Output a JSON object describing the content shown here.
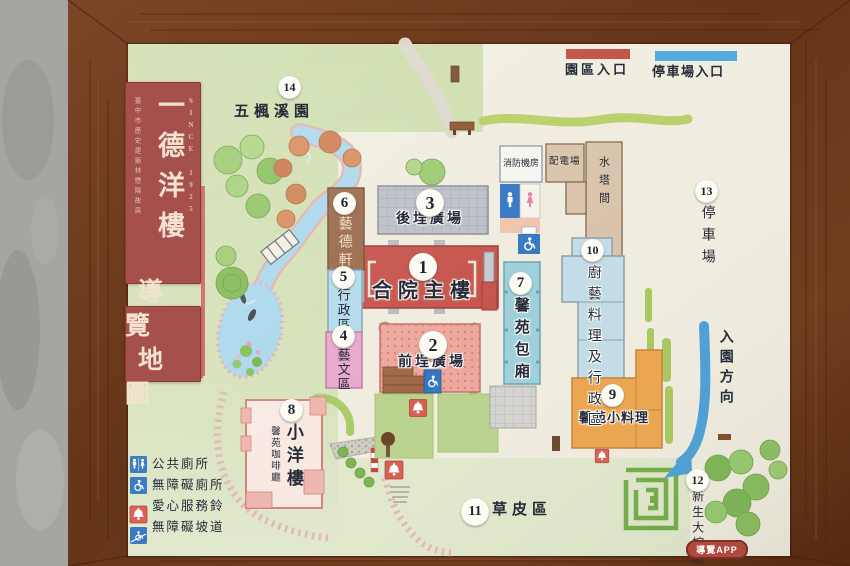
{
  "sign": {
    "name_vertical": "一德洋樓",
    "since": "SINCE 1925",
    "heritage_note": "臺中市歷史建築林懋陽故居",
    "map_title_lines": [
      "導覽",
      "地圖"
    ],
    "app_badge": "導覽APP"
  },
  "entrance_legend": [
    {
      "label": "園區入口",
      "color": "#c24b40"
    },
    {
      "label": "停車場入口",
      "color": "#4fa8dd"
    }
  ],
  "locations": [
    {
      "num": "1",
      "label": "合院主樓"
    },
    {
      "num": "2",
      "label": "前埕廣場"
    },
    {
      "num": "3",
      "label": "後埕廣場"
    },
    {
      "num": "4",
      "label": "藝文區"
    },
    {
      "num": "5",
      "label": "行政區"
    },
    {
      "num": "6",
      "label": "藝德軒"
    },
    {
      "num": "7",
      "label": "馨苑包廂"
    },
    {
      "num": "8",
      "label": "小洋樓",
      "sublabel": "馨苑咖啡廳"
    },
    {
      "num": "9",
      "label": "馨苑小料理"
    },
    {
      "num": "10",
      "label": "廚藝料理及行政區"
    },
    {
      "num": "11",
      "label": "草皮區"
    },
    {
      "num": "12",
      "label": "新生大榕樹"
    },
    {
      "num": "13",
      "label": "停車場"
    },
    {
      "num": "14",
      "label": "五楓溪園"
    }
  ],
  "facilities": {
    "fire_pump_room": "消防機房",
    "power_distribution": "配電場",
    "water_tower_room": "水塔間",
    "entry_direction": "入園方向"
  },
  "amenities_legend": [
    {
      "label": "公共廁所"
    },
    {
      "label": "無障礙廁所"
    },
    {
      "label": "愛心服務鈴"
    },
    {
      "label": "無障礙坡道"
    }
  ]
}
